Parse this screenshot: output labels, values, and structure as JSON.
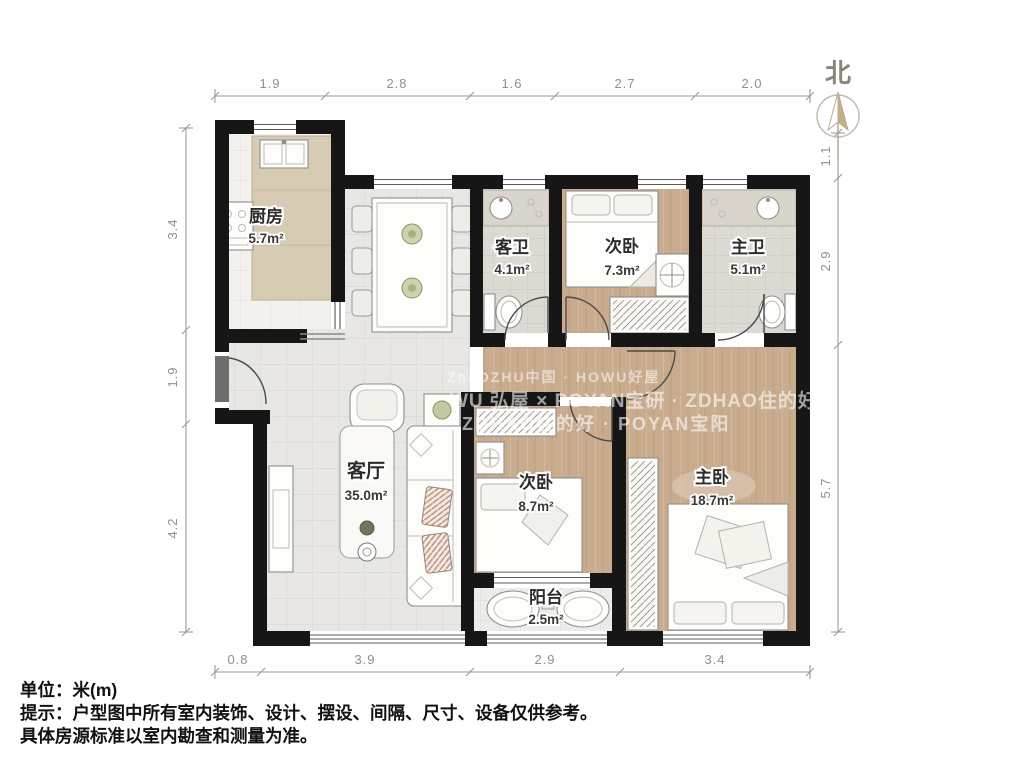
{
  "plan": {
    "rooms": {
      "kitchen": {
        "name": "厨房",
        "area": "5.7m²"
      },
      "guest_bath": {
        "name": "客卫",
        "area": "4.1m²"
      },
      "bedroom_second_top": {
        "name": "次卧",
        "area": "7.3m²"
      },
      "master_bath": {
        "name": "主卫",
        "area": "5.1m²"
      },
      "living": {
        "name": "客厅",
        "area": "35.0m²"
      },
      "bedroom_second": {
        "name": "次卧",
        "area": "8.7m²"
      },
      "master_bedroom": {
        "name": "主卧",
        "area": "18.7m²"
      },
      "balcony": {
        "name": "阳台",
        "area": "2.5m²"
      }
    },
    "dimensions": {
      "top": [
        "1.9",
        "2.8",
        "1.6",
        "2.7",
        "2.0"
      ],
      "left": [
        "3.4",
        "1.9",
        "4.2"
      ],
      "right": [
        "1.1",
        "2.9",
        "5.7"
      ],
      "bottom": [
        "0.8",
        "3.9",
        "2.9",
        "3.4"
      ]
    },
    "compass": {
      "label": "北"
    },
    "watermark": {
      "line1": "ZhaOZHU中国 · HOWU好屋",
      "line2": "WU 弘屋 × POYAN宝研 · ZDHAO住的好",
      "line3": "ZDHAO住的好 · POYAN宝阳"
    },
    "colors": {
      "wall": "#161616",
      "wood_floor": "#c9ab8e",
      "tile_floor": "#e9e7e3",
      "compass_accent": "#c9ad89",
      "dimension_text": "#8f8f8f"
    }
  },
  "notes": {
    "unit": "单位：米(m)",
    "tip_line1": "提示：户型图中所有室内装饰、设计、摆设、间隔、尺寸、设备仅供参考。",
    "tip_line2": "具体房源标准以室内勘查和测量为准。"
  }
}
